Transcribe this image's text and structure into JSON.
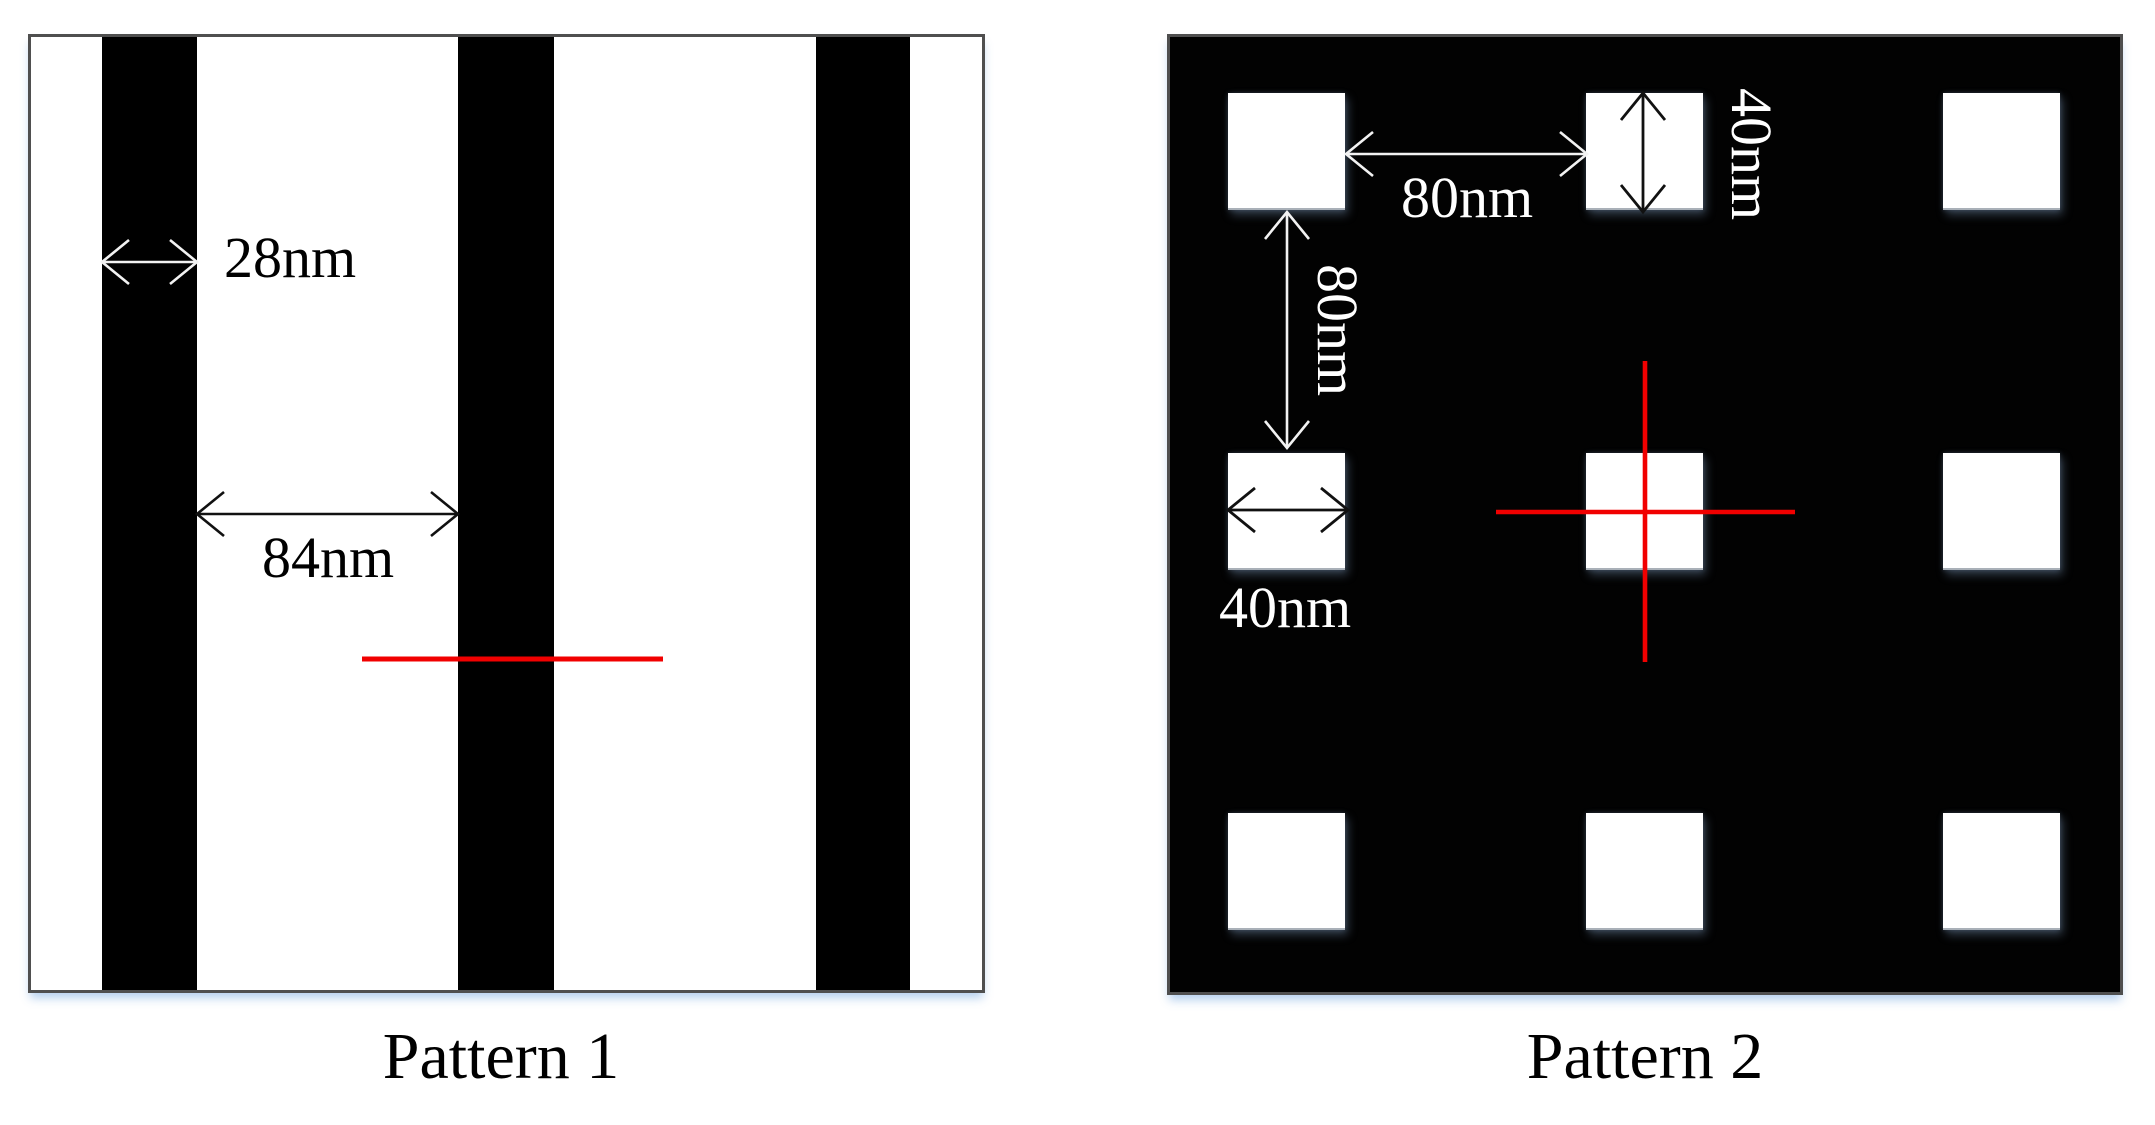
{
  "figure": {
    "pattern1": {
      "caption": "Pattern 1",
      "dims": {
        "line_width": "28nm",
        "space_width": "84nm"
      }
    },
    "pattern2": {
      "caption": "Pattern 2",
      "dims": {
        "horizontal_gap": "80nm",
        "square_height": "40nm",
        "vertical_gap": "80nm",
        "square_width": "40nm"
      }
    },
    "colors": {
      "pattern_black": "#020202",
      "pattern_white": "#ffffff",
      "box_border_gray": "#4f4f4f",
      "annotation_red": "#f10000",
      "dim_text_on_white": "#000000",
      "dim_text_on_black": "#ffffff"
    }
  }
}
